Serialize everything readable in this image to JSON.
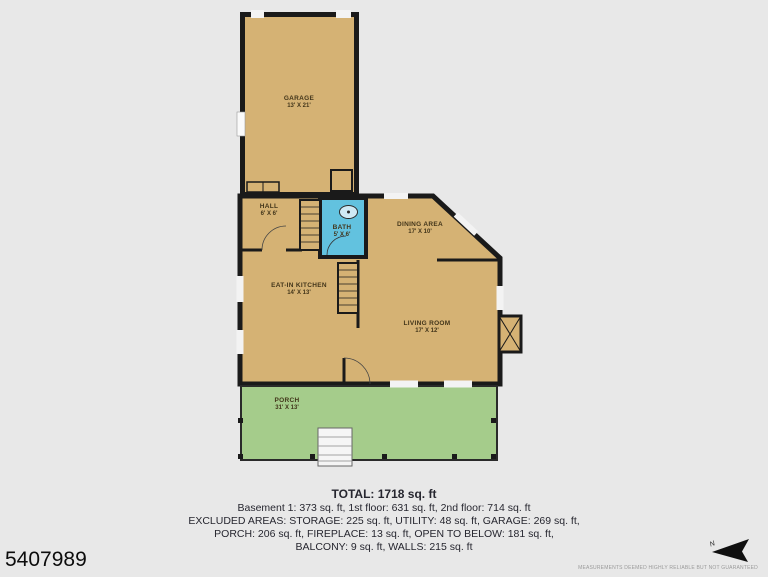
{
  "listing": {
    "id": "5407989"
  },
  "compass": {
    "label": "N"
  },
  "rooms": {
    "garage": {
      "name": "GARAGE",
      "dims": "13' X 21'"
    },
    "hall": {
      "name": "HALL",
      "dims": "6' X 6'"
    },
    "bath": {
      "name": "BATH",
      "dims": "5' X 6'"
    },
    "dining": {
      "name": "DINING AREA",
      "dims": "17' X 10'"
    },
    "kitchen": {
      "name": "EAT-IN KITCHEN",
      "dims": "14' X 13'"
    },
    "living": {
      "name": "LIVING ROOM",
      "dims": "17' X 12'"
    },
    "porch": {
      "name": "PORCH",
      "dims": "31' X 13'"
    }
  },
  "summary": {
    "total": "TOTAL: 1718 sq. ft",
    "line1": "Basement 1: 373 sq. ft, 1st floor: 631 sq. ft, 2nd floor: 714 sq. ft",
    "line2": "EXCLUDED AREAS: STORAGE: 225 sq. ft, UTILITY: 48 sq. ft, GARAGE: 269 sq. ft,",
    "line3": "PORCH: 206 sq. ft, FIREPLACE: 13 sq. ft, OPEN TO BELOW: 181 sq. ft,",
    "line4": "BALCONY: 9 sq. ft, WALLS: 215 sq. ft"
  },
  "disclaimer": "MEASUREMENTS DEEMED HIGHLY RELIABLE BUT NOT GUARANTEED",
  "colors": {
    "floor_tan": "#d5b274",
    "bath_blue": "#62c2df",
    "porch_green": "#a5cc8b",
    "wall": "#1a1a1a",
    "background": "#e8e8e8",
    "window_gap": "#f3f3f3"
  }
}
